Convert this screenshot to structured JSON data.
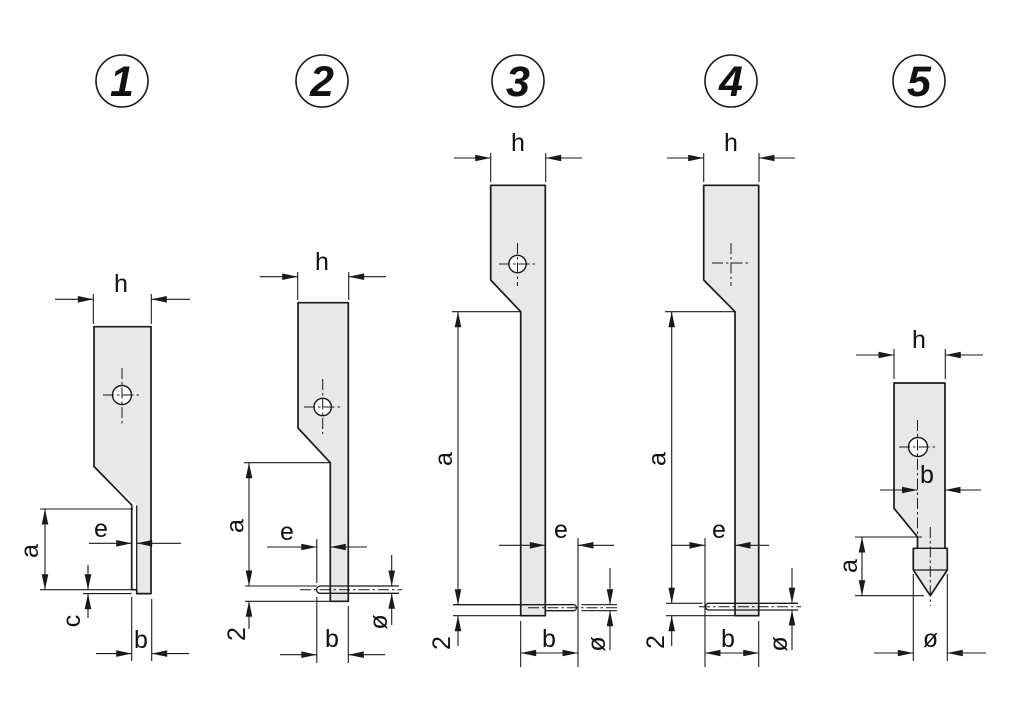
{
  "colors": {
    "background": "#ffffff",
    "part_fill": "#e8e8e8",
    "line_color": "#1a1a1a"
  },
  "figures": [
    {
      "number": "1",
      "labels": {
        "h": "h",
        "a": "a",
        "e": "e",
        "c": "c",
        "b": "b"
      }
    },
    {
      "number": "2",
      "labels": {
        "h": "h",
        "a": "a",
        "e": "e",
        "b": "b",
        "offset": "2",
        "diameter": "ø"
      }
    },
    {
      "number": "3",
      "labels": {
        "h": "h",
        "a": "a",
        "e": "e",
        "b": "b",
        "offset": "2",
        "diameter": "ø"
      }
    },
    {
      "number": "4",
      "labels": {
        "h": "h",
        "a": "a",
        "e": "e",
        "b": "b",
        "offset": "2",
        "diameter": "ø"
      }
    },
    {
      "number": "5",
      "labels": {
        "h": "h",
        "a": "a",
        "b": "b",
        "diameter": "ø"
      }
    }
  ]
}
